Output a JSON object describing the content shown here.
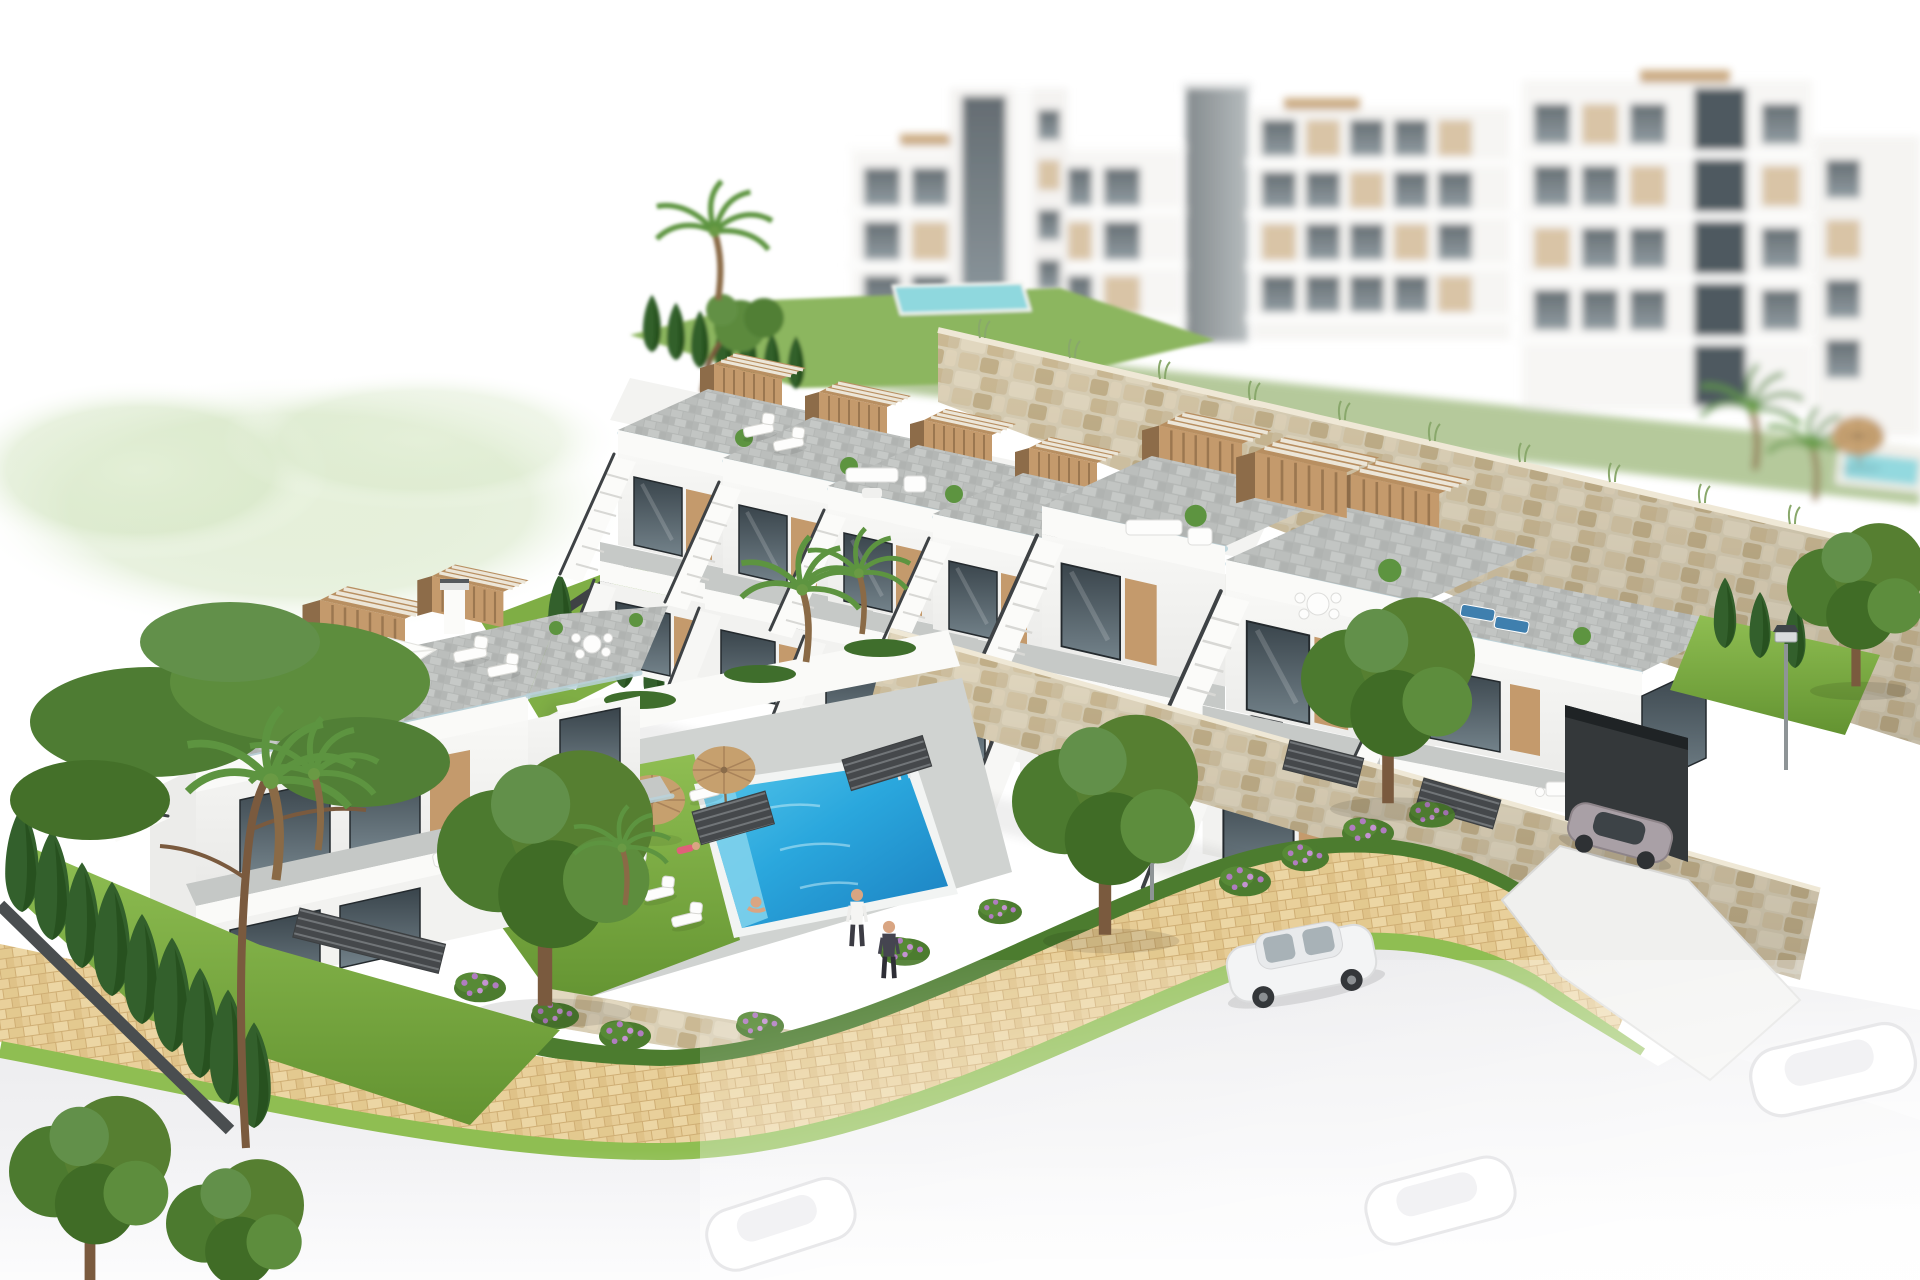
{
  "scene": {
    "title": "Aerial 3D architectural rendering of a modern white hillside residential complex with stepped townhouses, rooftop terraces, gardens and a communal swimming pool",
    "style": "photorealistic CGI visualization fading to a white background at the edges",
    "areas": {
      "background": "blurred multi-storey white apartment blocks with beige balcony panels, a dark grey lift shaft and a small rooftop pool",
      "midground": "two stepped rows of white townhouses with roof solariums, tan wood pergolas, glass balustrades and external staircases above rubble stone retaining walls",
      "left": "detached duplex with roof terrace, white parasol, pergolas, chimney and a private garden with a large pine, palm trees and a cypress hedge",
      "center": "communal courtyard with turquoise swimming pool, lawn, white sun loungers and two straw parasols",
      "right": "end townhouse with garage entrance in a stone wall, white driveway and an arriving grey sports car",
      "foreground": "curved street with clay-paver sidewalk, hedges, dark slatted fences, purple flowering shrubs, solar street lamps, a parked white car, two pedestrians and faded ghost cars at the image edge"
    }
  },
  "objects": {
    "townhouse_units_upper_row": 4,
    "townhouse_units_lower_row": 3,
    "rooftop_pergolas": 9,
    "pool_parasols": 2,
    "pool_sun_loungers": 6,
    "pedestrians": 2,
    "people_total": 6,
    "street_lamps": 2,
    "cars_sharp": 2,
    "cars_faded_edge": 3
  },
  "palette": {
    "canvas": "#ffffff",
    "wall_white": "#fafaf8",
    "wall_shade": "#ececea",
    "deck_grey": "#bcbfbd",
    "glazing_dark": "#3c474d",
    "glazing_light": "#77858c",
    "glass_rail": "#b9d2da",
    "wood_tan": "#c49a6c",
    "wood_dark": "#8d6c49",
    "stone_light": "#e4dbc6",
    "stone_dark": "#bfae88",
    "grass": "#71a43a",
    "grass_bright": "#8fbe52",
    "hedge": "#4c7c2f",
    "cypress": "#33602c",
    "tree": "#567f31",
    "palm": "#5d9440",
    "pool_deep": "#1b7fc0",
    "pool_light": "#55c6ea",
    "pool_bg": "#8fd8de",
    "sidewalk_tan": "#e6cc96",
    "road_grey": "#ededef",
    "fence_dark": "#46494c",
    "flower_purple": "#b07cc0",
    "skin": "#d9a582",
    "car_white": "#f3f4f5",
    "car_grey": "#a9a0a6",
    "thatch": "#c6a06e"
  }
}
